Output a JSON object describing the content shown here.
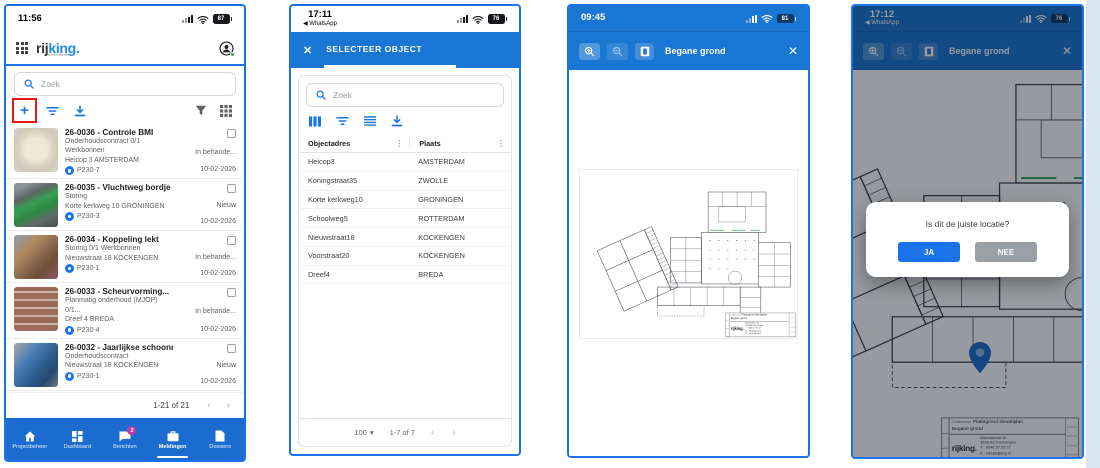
{
  "icons": {
    "close": "✕",
    "back_arrow": "◀",
    "chevron_left": "‹",
    "chevron_right": "›",
    "caret_down": "▾",
    "kebab": "⋮",
    "plus": "+"
  },
  "colors": {
    "accent_blue": "#1a73e8",
    "appbar_blue": "#1976d2",
    "nav_blue": "#1b6bd0",
    "badge_pink": "#c2399e",
    "green_presence_dot": "#34a853",
    "highlight_red": "#e81717",
    "pin_blue": "#1d6ecf"
  },
  "phone1": {
    "statusbar": {
      "time": "11:56",
      "battery": "87"
    },
    "header": {
      "logo_dark": "rij",
      "logo_blue": "king.",
      "tagline": "bouwkundig advies"
    },
    "search": {
      "placeholder": "Zoek"
    },
    "list": [
      {
        "title": "26-0036 - Controle BMI",
        "line2": "Onderhoudscontract  0/1 Werkbonnen",
        "line3": "Heicop 3 AMSTERDAM",
        "code": "P230-7",
        "status": "In behande...",
        "date": "10-02-2026"
      },
      {
        "title": "26-0035 - Vluchtweg bordje",
        "line2": "Storing",
        "line3": "Korte kerkweg 10 GRONINGEN",
        "code": "P230-3",
        "status": "Nieuw",
        "date": "10-02-2026"
      },
      {
        "title": "26-0034 - Koppeling lekt",
        "line2": "Storing  0/1 Werkbonnen",
        "line3": "Nieuwstraat 18 KOCKENGEN",
        "code": "P230-1",
        "status": "In behande...",
        "date": "10-02-2026"
      },
      {
        "title": "26-0033 - Scheurvorming...",
        "line2": "Planmatig onderhoud (MJOP)  0/1...",
        "line3": "Dreef 4 BREDA",
        "code": "P230-4",
        "status": "In behande...",
        "date": "10-02-2026"
      },
      {
        "title": "26-0032 - Jaarlijkse schoonmaak...",
        "line2": "Onderhoudscontract",
        "line3": "Nieuwstraat 18 KOCKENGEN",
        "code": "P230-1",
        "status": "Nieuw",
        "date": "10-02-2026"
      },
      {
        "title": "26-0031 - Ventilatie niet naar...",
        "line2": "",
        "line3": "",
        "code": "",
        "status": "",
        "date": ""
      }
    ],
    "pagination": {
      "range": "1-21 of 21"
    },
    "nav": [
      {
        "label": "Projectbeheer"
      },
      {
        "label": "Dashboard"
      },
      {
        "label": "Berichten",
        "badge": "2"
      },
      {
        "label": "Meldingen"
      },
      {
        "label": "Dossiers"
      }
    ]
  },
  "phone2": {
    "statusbar": {
      "time": "17:11",
      "back_app": "WhatsApp",
      "battery": "76"
    },
    "appbar": {
      "title": "SELECTEER OBJECT"
    },
    "search": {
      "placeholder": "Zoek"
    },
    "table": {
      "columns": [
        {
          "label": "Objectadres"
        },
        {
          "label": "Plaats"
        }
      ],
      "rows": [
        {
          "adres": "Heicop3",
          "plaats": "AMSTERDAM"
        },
        {
          "adres": "Koningstraat35",
          "plaats": "ZWOLLE"
        },
        {
          "adres": "Korte kerkweg10",
          "plaats": "GRONINGEN"
        },
        {
          "adres": "Schoolweg5",
          "plaats": "ROTTERDAM"
        },
        {
          "adres": "Nieuwstraat18",
          "plaats": "KOCKENGEN"
        },
        {
          "adres": "Voorstraat20",
          "plaats": "KOCKENGEN"
        },
        {
          "adres": "Dreef4",
          "plaats": "BREDA"
        }
      ]
    },
    "footer": {
      "page_size": "100",
      "range": "1-7 of 7"
    }
  },
  "phone3": {
    "statusbar": {
      "time": "09:45",
      "battery": "81"
    },
    "appbar": {
      "title": "Begane grond"
    }
  },
  "phone4": {
    "statusbar": {
      "time": "17:12",
      "back_app": "WhatsApp",
      "battery": "76"
    },
    "appbar": {
      "title": "Begane grond"
    },
    "dialog": {
      "message": "Is dit de juiste locatie?",
      "yes_label": "JA",
      "no_label": "NEE"
    }
  },
  "titleblock": {
    "label": "Onderwerp:",
    "subject": "Plattegrond sleutelplan",
    "floor": "Begane grond",
    "logo_dark": "rij",
    "logo_blue": "king.",
    "address_lines": [
      "Nieuwstraat 18",
      "3628 AC Kockengen",
      "T : 0346 27 55 27",
      "E : info@rijking.nl",
      "W : www.rijking.nl"
    ]
  }
}
